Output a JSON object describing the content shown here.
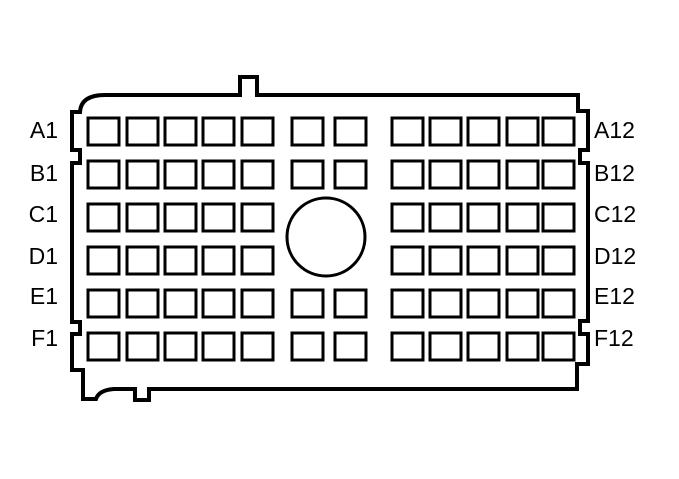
{
  "diagram": {
    "title": "connector-face-pinout",
    "background_color": "#ffffff",
    "line_color": "#000000",
    "rows": [
      {
        "left_label": "A1",
        "right_label": "A12",
        "columns": [
          1,
          2,
          3,
          4,
          5,
          6,
          7,
          8,
          9,
          10,
          11,
          12
        ]
      },
      {
        "left_label": "B1",
        "right_label": "B12",
        "columns": [
          1,
          2,
          3,
          4,
          5,
          6,
          7,
          8,
          9,
          10,
          11,
          12
        ]
      },
      {
        "left_label": "C1",
        "right_label": "C12",
        "columns": [
          1,
          2,
          3,
          4,
          5,
          8,
          9,
          10,
          11,
          12
        ]
      },
      {
        "left_label": "D1",
        "right_label": "D12",
        "columns": [
          1,
          2,
          3,
          4,
          5,
          8,
          9,
          10,
          11,
          12
        ]
      },
      {
        "left_label": "E1",
        "right_label": "E12",
        "columns": [
          1,
          2,
          3,
          4,
          5,
          6,
          7,
          8,
          9,
          10,
          11,
          12
        ]
      },
      {
        "left_label": "F1",
        "right_label": "F12",
        "columns": [
          1,
          2,
          3,
          4,
          5,
          6,
          7,
          8,
          9,
          10,
          11,
          12
        ]
      }
    ],
    "features": {
      "center_circle": true,
      "top_alignment_tab": true,
      "bottom_alignment_tabs": 2
    }
  }
}
